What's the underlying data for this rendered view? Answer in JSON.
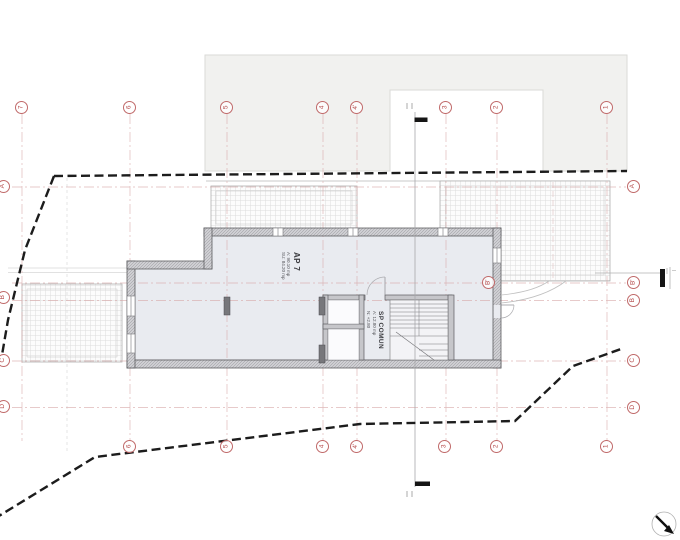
{
  "plan": {
    "rooms": {
      "ap7": {
        "name": "AP 7",
        "line1": "A: 90.10 mp",
        "line2": "SU: 84.20 mp"
      },
      "sp_comun": {
        "name": "SP COMUN",
        "line1": "A: 12.80 mp",
        "line2": "N: +2.80"
      }
    },
    "grid": {
      "top": [
        "7",
        "6",
        "5",
        "4",
        "4'",
        "3",
        "2",
        "1"
      ],
      "bottom": [
        "6",
        "5",
        "4",
        "4'",
        "3",
        "2",
        "1"
      ],
      "left": [
        "A",
        "B",
        "C",
        "D"
      ],
      "right": [
        "A",
        "B'",
        "B",
        "C",
        "D"
      ],
      "inline_b": "B'"
    },
    "colors": {
      "grid_marker": "#b34747",
      "boundary": "#1c1c1c",
      "wall_outline": "#5c5c60",
      "floor": "#e9ebf0",
      "neighbor_fill": "#f1f1ef"
    }
  }
}
